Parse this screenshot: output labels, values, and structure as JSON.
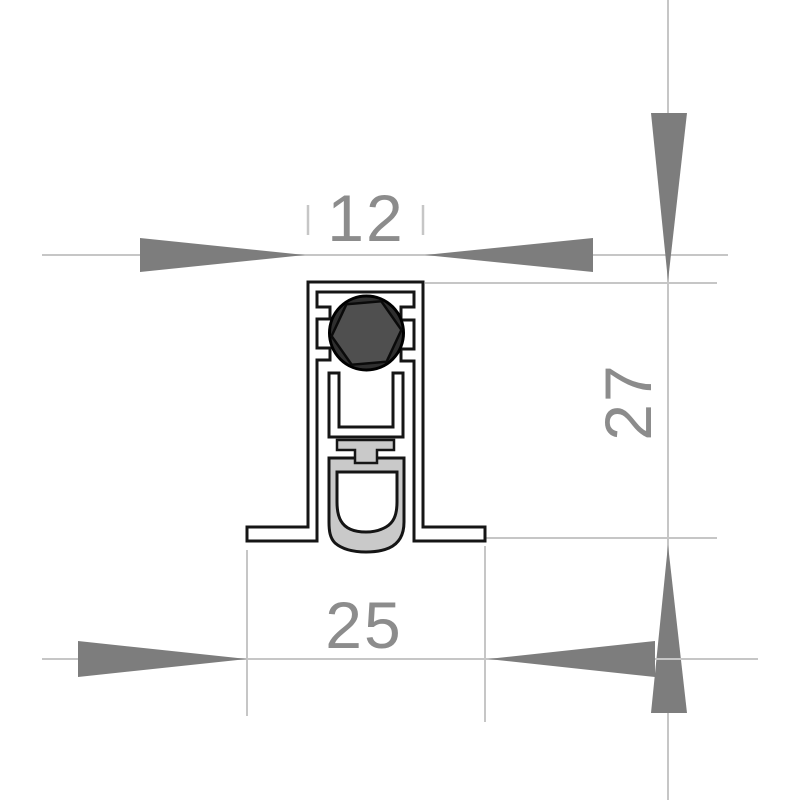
{
  "drawing": {
    "type": "technical-cross-section",
    "subject": "automatic-door-bottom-seal-profile",
    "dimensions": [
      {
        "id": "top-width",
        "value": "12",
        "orientation": "horizontal",
        "position": "top"
      },
      {
        "id": "overall-height",
        "value": "27",
        "orientation": "vertical",
        "position": "right"
      },
      {
        "id": "bottom-width",
        "value": "25",
        "orientation": "horizontal",
        "position": "bottom"
      }
    ],
    "parts": [
      {
        "name": "aluminium-housing"
      },
      {
        "name": "mounting-flanges"
      },
      {
        "name": "actuator-circle"
      },
      {
        "name": "actuator-hexagon"
      },
      {
        "name": "inner-slide-channel"
      },
      {
        "name": "seal-carrier"
      },
      {
        "name": "rubber-gasket"
      }
    ],
    "colors": {
      "outline": "#151515",
      "profile_fill": "#ffffff",
      "rubber_gray": "#c9c9c9",
      "circle_fill": "#2f2f2f",
      "hexagon_fill": "#4f4f4f",
      "dim_line_gray": "#c6c6c6",
      "arrow_gray": "#7d7d7d",
      "label_gray": "#8c8c8c"
    }
  }
}
